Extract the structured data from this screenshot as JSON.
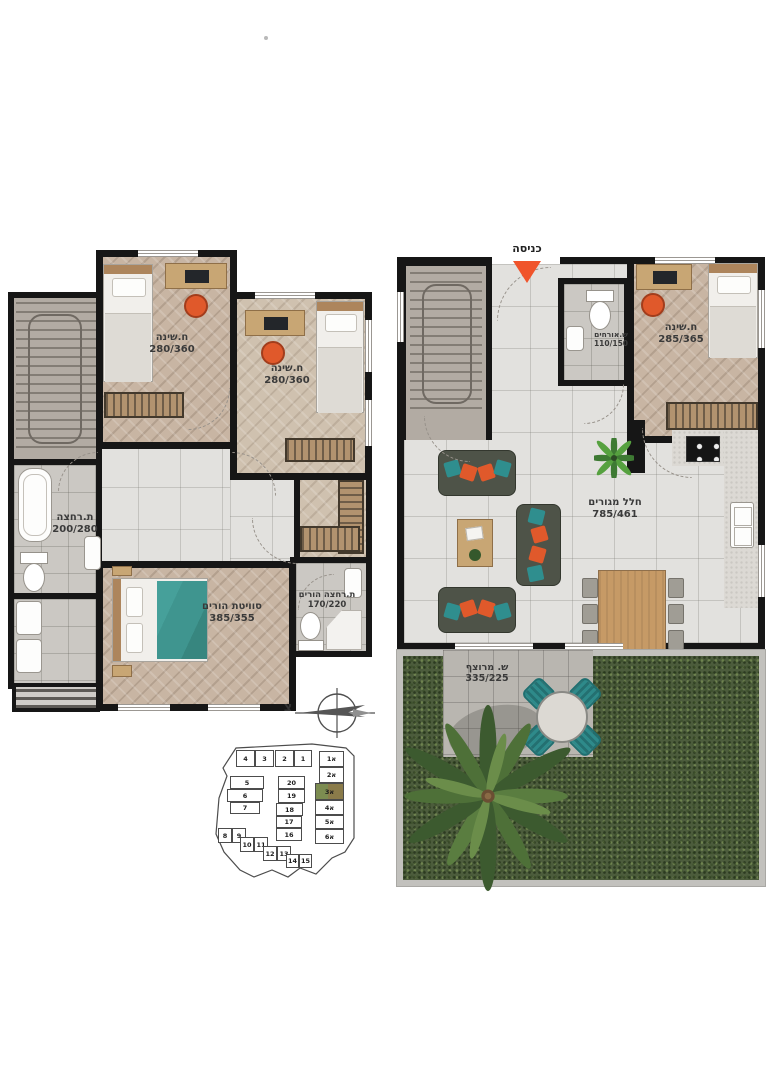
{
  "floors": {
    "upper": {
      "rooms": {
        "bedroom1": {
          "name": "ח.שינה",
          "dims": "280/360"
        },
        "bedroom2": {
          "name": "ח.שינה",
          "dims": "280/360"
        },
        "bathroom": {
          "name": "ת.רחצה",
          "dims": "200/280"
        },
        "parents_suite": {
          "name": "סוויטת הורים",
          "dims": "385/355"
        },
        "parents_bathroom": {
          "name": "ת.רחצה הורים",
          "dims": "170/220"
        }
      }
    },
    "ground": {
      "entrance_label": "כניסה",
      "rooms": {
        "guest_wc": {
          "name": "ש.אורחים",
          "dims": "110/150"
        },
        "bedroom": {
          "name": "ח.שינה",
          "dims": "285/365"
        },
        "living": {
          "name": "חלל מגורים",
          "dims": "785/461"
        },
        "paved_yard": {
          "name": "ש. מרוצף",
          "dims": "335/225"
        }
      }
    }
  },
  "compass": {
    "north_label": "צ"
  },
  "site_plan": {
    "highlighted_unit": "3א",
    "units": [
      {
        "label": "4"
      },
      {
        "label": "3"
      },
      {
        "label": "2"
      },
      {
        "label": "1"
      },
      {
        "label": "1א"
      },
      {
        "label": "2א"
      },
      {
        "label": "5"
      },
      {
        "label": "6"
      },
      {
        "label": "7"
      },
      {
        "label": "20"
      },
      {
        "label": "19"
      },
      {
        "label": "18"
      },
      {
        "label": "17"
      },
      {
        "label": "16"
      },
      {
        "label": "3א",
        "highlight": true
      },
      {
        "label": "4א"
      },
      {
        "label": "5א"
      },
      {
        "label": "6א"
      },
      {
        "label": "8"
      },
      {
        "label": "9"
      },
      {
        "label": "10"
      },
      {
        "label": "11"
      },
      {
        "label": "12"
      },
      {
        "label": "13"
      },
      {
        "label": "14"
      },
      {
        "label": "15"
      }
    ]
  },
  "colors": {
    "wall": "#161616",
    "entrance_arrow": "#f0542b",
    "accent_orange": "#e0592b",
    "accent_teal": "#2f8e8e",
    "bed_teal": "#3f958f",
    "highlight_green": "#7c8c51",
    "highlight_olive": "#8a7b4a"
  }
}
